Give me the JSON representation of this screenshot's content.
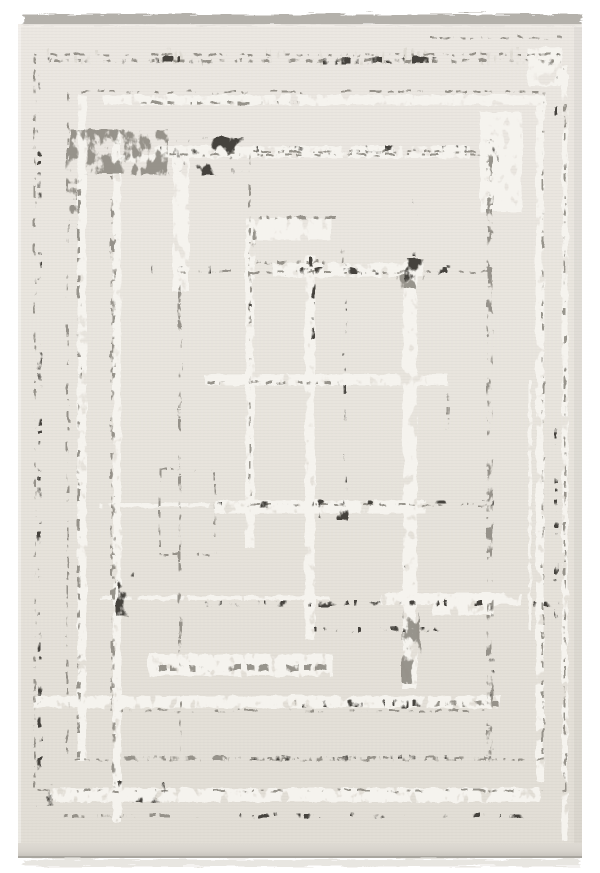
{
  "meta": {
    "description": "Top-down product photograph of a rectangular cream area rug with an abstract distressed geometric pattern of overlapping gray rectangles, with fringe on the top and bottom edges",
    "alt": "Cream and gray modern abstract geometric area rug"
  },
  "palette": {
    "page_bg": "#ffffff",
    "rug_base": "#e8e4dd",
    "rug_base_light": "#ebe7e1",
    "rug_base_dark": "#e1ddd5",
    "fringe": "#b4b1ab",
    "fringe_bottom": "#e8e6e1",
    "edge_strip_top": "#dedad3",
    "edge_strip_bottom": "#c9c5be",
    "edge_line": "#a9a69f",
    "dark": "#44423d",
    "mid": "#908c84",
    "silver": "#f5f3ee",
    "light": "#dcd8d0"
  },
  "rug": {
    "canvas": {
      "w": 600,
      "h": 873
    },
    "body": {
      "x": 18,
      "y": 24,
      "w": 564,
      "h": 820
    },
    "fringe_top": {
      "x": 22,
      "y": 13,
      "w": 558,
      "h": 11
    },
    "edge_bottom": {
      "x": 18,
      "y": 843,
      "w": 564,
      "h": 13
    },
    "pattern": {
      "lines": [
        {
          "tone": "light",
          "x1": 40,
          "y1": 57,
          "x2": 560,
          "y2": 57,
          "w": 16
        },
        {
          "tone": "mid",
          "x1": 45,
          "y1": 61,
          "x2": 555,
          "y2": 61,
          "w": 3
        },
        {
          "tone": "dark",
          "x1": 118,
          "y1": 61,
          "x2": 468,
          "y2": 61,
          "w": 6
        },
        {
          "tone": "silver",
          "x1": 103,
          "y1": 100,
          "x2": 546,
          "y2": 100,
          "w": 10
        },
        {
          "tone": "mid",
          "x1": 140,
          "y1": 103,
          "x2": 300,
          "y2": 103,
          "w": 3
        },
        {
          "tone": "mid",
          "x1": 430,
          "y1": 38,
          "x2": 562,
          "y2": 38,
          "w": 2
        },
        {
          "tone": "silver",
          "x1": 155,
          "y1": 152,
          "x2": 470,
          "y2": 152,
          "w": 12
        },
        {
          "tone": "dark",
          "x1": 160,
          "y1": 149,
          "x2": 466,
          "y2": 149,
          "w": 5
        },
        {
          "tone": "silver",
          "x1": 112,
          "y1": 158,
          "x2": 155,
          "y2": 158,
          "w": 7
        },
        {
          "tone": "dark",
          "x1": 150,
          "y1": 270,
          "x2": 272,
          "y2": 270,
          "w": 9
        },
        {
          "tone": "silver",
          "x1": 273,
          "y1": 270,
          "x2": 423,
          "y2": 270,
          "w": 14
        },
        {
          "tone": "dark",
          "x1": 272,
          "y1": 272,
          "x2": 470,
          "y2": 272,
          "w": 6
        },
        {
          "tone": "dark",
          "x1": 423,
          "y1": 268,
          "x2": 470,
          "y2": 268,
          "w": 3
        },
        {
          "tone": "silver",
          "x1": 205,
          "y1": 380,
          "x2": 448,
          "y2": 380,
          "w": 11
        },
        {
          "tone": "mid",
          "x1": 208,
          "y1": 383,
          "x2": 340,
          "y2": 383,
          "w": 3
        },
        {
          "tone": "silver",
          "x1": 100,
          "y1": 505,
          "x2": 210,
          "y2": 505,
          "w": 4
        },
        {
          "tone": "dark",
          "x1": 215,
          "y1": 505,
          "x2": 320,
          "y2": 505,
          "w": 6
        },
        {
          "tone": "silver",
          "x1": 215,
          "y1": 507,
          "x2": 425,
          "y2": 507,
          "w": 13
        },
        {
          "tone": "dark",
          "x1": 320,
          "y1": 503,
          "x2": 500,
          "y2": 503,
          "w": 4
        },
        {
          "tone": "silver",
          "x1": 100,
          "y1": 598,
          "x2": 330,
          "y2": 598,
          "w": 4
        },
        {
          "tone": "dark",
          "x1": 205,
          "y1": 604,
          "x2": 560,
          "y2": 604,
          "w": 5
        },
        {
          "tone": "silver",
          "x1": 380,
          "y1": 599,
          "x2": 522,
          "y2": 599,
          "w": 12
        },
        {
          "tone": "dark",
          "x1": 300,
          "y1": 630,
          "x2": 472,
          "y2": 630,
          "w": 5
        },
        {
          "tone": "silver",
          "x1": 148,
          "y1": 665,
          "x2": 333,
          "y2": 665,
          "w": 22
        },
        {
          "tone": "mid",
          "x1": 160,
          "y1": 668,
          "x2": 330,
          "y2": 668,
          "w": 6
        },
        {
          "tone": "silver",
          "x1": 35,
          "y1": 702,
          "x2": 500,
          "y2": 702,
          "w": 12
        },
        {
          "tone": "dark",
          "x1": 278,
          "y1": 704,
          "x2": 434,
          "y2": 704,
          "w": 7
        },
        {
          "tone": "mid",
          "x1": 434,
          "y1": 704,
          "x2": 500,
          "y2": 704,
          "w": 5
        },
        {
          "tone": "mid",
          "x1": 113,
          "y1": 758,
          "x2": 250,
          "y2": 758,
          "w": 3
        },
        {
          "tone": "dark",
          "x1": 250,
          "y1": 758,
          "x2": 492,
          "y2": 758,
          "w": 4
        },
        {
          "tone": "silver",
          "x1": 50,
          "y1": 795,
          "x2": 540,
          "y2": 795,
          "w": 14
        },
        {
          "tone": "dark",
          "x1": 170,
          "y1": 816,
          "x2": 528,
          "y2": 816,
          "w": 4
        },
        {
          "tone": "mid",
          "x1": 62,
          "y1": 816,
          "x2": 170,
          "y2": 816,
          "w": 3
        },
        {
          "tone": "dark",
          "x1": 40,
          "y1": 58,
          "x2": 40,
          "y2": 792,
          "w": 4
        },
        {
          "tone": "silver",
          "x1": 82,
          "y1": 95,
          "x2": 82,
          "y2": 762,
          "w": 9
        },
        {
          "tone": "mid",
          "x1": 79,
          "y1": 160,
          "x2": 79,
          "y2": 758,
          "w": 3
        },
        {
          "tone": "silver",
          "x1": 117,
          "y1": 130,
          "x2": 117,
          "y2": 822,
          "w": 8
        },
        {
          "tone": "mid",
          "x1": 114,
          "y1": 200,
          "x2": 114,
          "y2": 790,
          "w": 3
        },
        {
          "tone": "silver",
          "x1": 181,
          "y1": 152,
          "x2": 181,
          "y2": 292,
          "w": 16
        },
        {
          "tone": "mid",
          "x1": 180,
          "y1": 292,
          "x2": 180,
          "y2": 672,
          "w": 3
        },
        {
          "tone": "silver",
          "x1": 250,
          "y1": 240,
          "x2": 250,
          "y2": 548,
          "w": 9
        },
        {
          "tone": "dark",
          "x1": 252,
          "y1": 245,
          "x2": 252,
          "y2": 310,
          "w": 3
        },
        {
          "tone": "silver",
          "x1": 310,
          "y1": 255,
          "x2": 310,
          "y2": 640,
          "w": 10
        },
        {
          "tone": "dark",
          "x1": 313,
          "y1": 258,
          "x2": 313,
          "y2": 340,
          "w": 4
        },
        {
          "tone": "dark",
          "x1": 345,
          "y1": 250,
          "x2": 345,
          "y2": 520,
          "w": 3
        },
        {
          "tone": "silver",
          "x1": 410,
          "y1": 262,
          "x2": 410,
          "y2": 688,
          "w": 14
        },
        {
          "tone": "dark",
          "x1": 415,
          "y1": 170,
          "x2": 415,
          "y2": 262,
          "w": 3
        },
        {
          "tone": "mid",
          "x1": 448,
          "y1": 378,
          "x2": 448,
          "y2": 430,
          "w": 3
        },
        {
          "tone": "mid",
          "x1": 490,
          "y1": 140,
          "x2": 490,
          "y2": 762,
          "w": 6
        },
        {
          "tone": "dark",
          "x1": 492,
          "y1": 600,
          "x2": 492,
          "y2": 760,
          "w": 4
        },
        {
          "tone": "silver",
          "x1": 530,
          "y1": 380,
          "x2": 530,
          "y2": 630,
          "w": 3
        },
        {
          "tone": "silver",
          "x1": 540,
          "y1": 95,
          "x2": 540,
          "y2": 782,
          "w": 8
        },
        {
          "tone": "dark",
          "x1": 557,
          "y1": 62,
          "x2": 557,
          "y2": 120,
          "w": 3
        },
        {
          "tone": "dark",
          "x1": 557,
          "y1": 430,
          "x2": 557,
          "y2": 622,
          "w": 3
        },
        {
          "tone": "silver",
          "x1": 565,
          "y1": 65,
          "x2": 565,
          "y2": 840,
          "w": 6
        },
        {
          "tone": "mid",
          "x1": 72,
          "y1": 148,
          "x2": 72,
          "y2": 215,
          "w": 10
        }
      ],
      "blocks": [
        {
          "tone": "dark",
          "x": 43,
          "y": 56,
          "w": 9,
          "h": 9
        },
        {
          "tone": "dark",
          "x": 549,
          "y": 54,
          "w": 12,
          "h": 12
        },
        {
          "tone": "silver",
          "x": 480,
          "y": 112,
          "w": 42,
          "h": 100
        },
        {
          "tone": "dark",
          "x": 483,
          "y": 142,
          "w": 18,
          "h": 20
        },
        {
          "tone": "mid",
          "x": 70,
          "y": 130,
          "w": 98,
          "h": 45
        },
        {
          "tone": "dark",
          "x": 168,
          "y": 138,
          "w": 76,
          "h": 38
        },
        {
          "tone": "silver",
          "x": 247,
          "y": 218,
          "w": 84,
          "h": 22
        },
        {
          "tone": "mid",
          "x": 397,
          "y": 275,
          "w": 27,
          "h": 14
        },
        {
          "tone": "dark",
          "x": 405,
          "y": 258,
          "w": 20,
          "h": 26
        },
        {
          "tone": "dark",
          "x": 337,
          "y": 503,
          "w": 12,
          "h": 18
        },
        {
          "tone": "dark",
          "x": 320,
          "y": 505,
          "w": 12,
          "h": 13
        },
        {
          "tone": "dark",
          "x": 404,
          "y": 545,
          "w": 14,
          "h": 24
        },
        {
          "tone": "mid",
          "x": 402,
          "y": 612,
          "w": 18,
          "h": 72
        },
        {
          "tone": "dark",
          "x": 118,
          "y": 573,
          "w": 16,
          "h": 44
        },
        {
          "tone": "dark",
          "x": 38,
          "y": 780,
          "w": 16,
          "h": 26
        },
        {
          "tone": "dark",
          "x": 118,
          "y": 783,
          "w": 46,
          "h": 20
        },
        {
          "tone": "silver",
          "x": 528,
          "y": 48,
          "w": 34,
          "h": 38
        },
        {
          "tone": "silver",
          "x": 433,
          "y": 593,
          "w": 60,
          "h": 22
        }
      ],
      "outlines": [
        {
          "x": 255,
          "y": 218,
          "w": 88,
          "h": 44,
          "sw": 3
        },
        {
          "x": 180,
          "y": 272,
          "w": 312,
          "h": 486,
          "sw": 2
        },
        {
          "x": 250,
          "y": 152,
          "w": 240,
          "h": 353,
          "sw": 2
        },
        {
          "x": 35,
          "y": 55,
          "w": 530,
          "h": 736,
          "sw": 2
        },
        {
          "x": 68,
          "y": 92,
          "w": 475,
          "h": 668,
          "sw": 2
        },
        {
          "x": 112,
          "y": 155,
          "w": 380,
          "h": 556,
          "sw": 2
        },
        {
          "x": 160,
          "y": 470,
          "w": 55,
          "h": 85,
          "sw": 2
        }
      ]
    }
  }
}
